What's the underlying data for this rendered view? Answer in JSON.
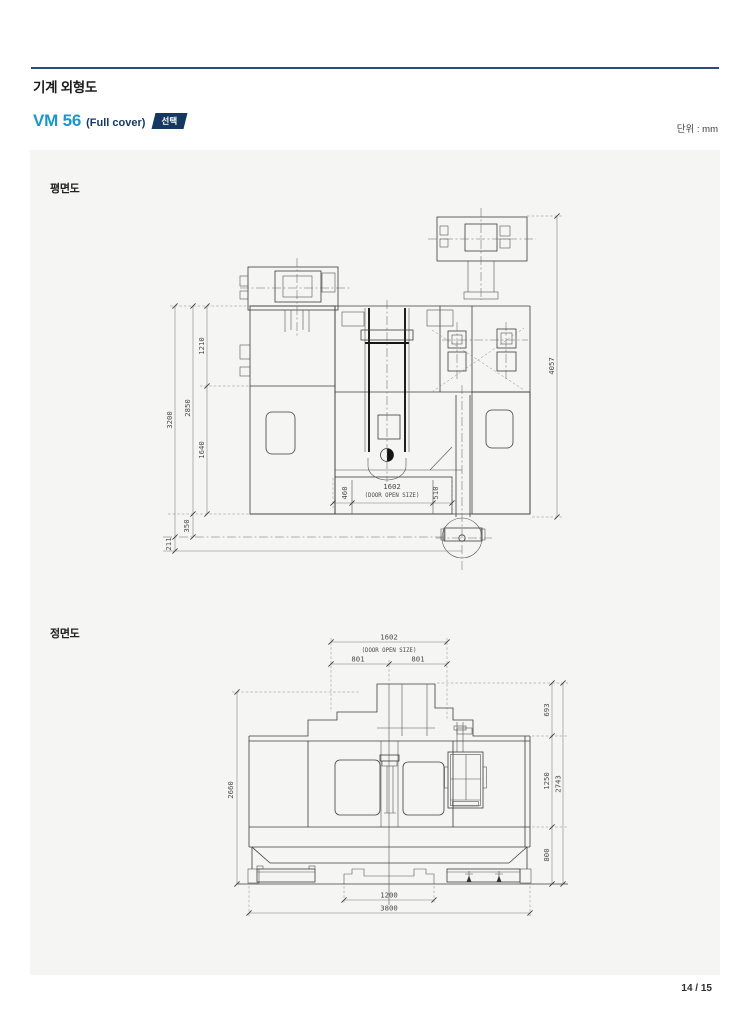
{
  "page": {
    "title": "기계 외형도",
    "model_name": "VM 56",
    "model_variant": "(Full cover)",
    "option_badge": "선택",
    "unit_label": "단위 : mm",
    "page_number": "14 / 15"
  },
  "plan_view": {
    "label": "평면도",
    "dims": {
      "total_width": "3200",
      "body_width": "2850",
      "upper_width": "1210",
      "lower_width": "1640",
      "rear_offset": "350",
      "conveyor_offset": "211",
      "total_depth": "4057",
      "door_open": "1602",
      "door_open_note": "(DOOR OPEN SIZE)",
      "door_left": "460",
      "door_right": "510"
    }
  },
  "front_view": {
    "label": "정면도",
    "dims": {
      "door_open": "1602",
      "door_open_note": "(DOOR OPEN SIZE)",
      "door_half_left": "801",
      "door_half_right": "801",
      "head_height": "693",
      "window_height": "1250",
      "base_height": "800",
      "upper_total_height": "2743",
      "machine_height": "2660",
      "jack_span": "1200",
      "total_width": "3800"
    }
  },
  "colors": {
    "accent_blue": "#1e96c9",
    "navy": "#16375f",
    "rule_blue": "#2b4d7e",
    "panel_bg": "#f5f5f4",
    "line": "#3d3d3d"
  }
}
